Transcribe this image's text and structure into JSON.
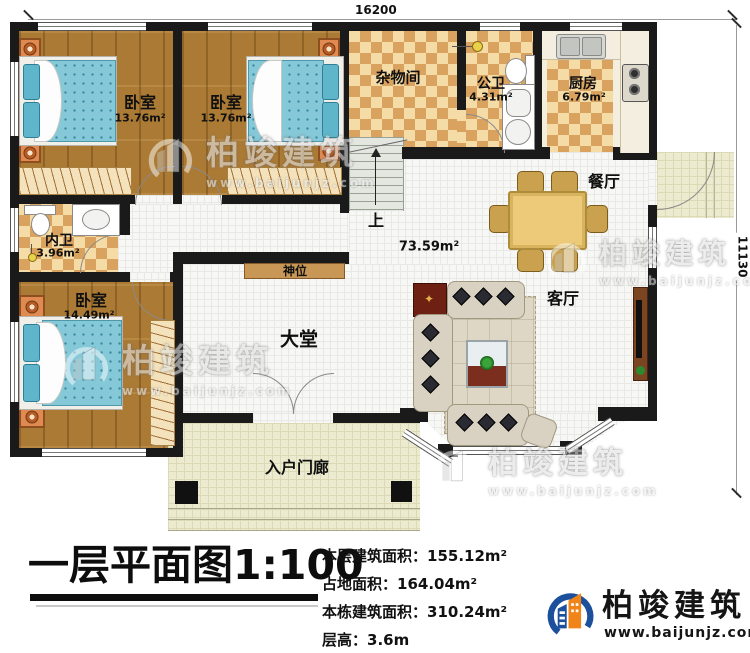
{
  "dimensions": {
    "top": "16200",
    "right": "11130"
  },
  "rooms": {
    "bedroom1": {
      "label": "卧室",
      "area": "13.76m²"
    },
    "bedroom2": {
      "label": "卧室",
      "area": "13.76m²"
    },
    "bedroom3": {
      "label": "卧室",
      "area": "14.49m²"
    },
    "storage": {
      "label": "杂物间"
    },
    "public_bath": {
      "label": "公卫",
      "area": "4.31m²"
    },
    "kitchen": {
      "label": "厨房",
      "area": "6.79m²"
    },
    "dining": {
      "label": "餐厅"
    },
    "living": {
      "label": "客厅"
    },
    "hall": {
      "label": "大堂"
    },
    "inner_bath": {
      "label": "内卫",
      "area": "3.96m²"
    },
    "porch": {
      "label": "入户门廊"
    },
    "open_area": {
      "area": "73.59m²"
    },
    "shrine": {
      "label": "神位"
    },
    "stairs": {
      "label": "上"
    }
  },
  "title_block": {
    "title": "一层平面图1:100",
    "stats": [
      {
        "label": "本层建筑面积：",
        "value": "155.12m²"
      },
      {
        "label": "占地面积：",
        "value": "164.04m²"
      },
      {
        "label": "本栋建筑面积：",
        "value": "310.24m²"
      },
      {
        "label": "层高：",
        "value": "3.6m"
      }
    ]
  },
  "brand": {
    "name": "柏竣建筑",
    "website": "www.baijunjz.com"
  },
  "colors": {
    "wall": "#1a1a1a",
    "checker_dark": "#daa25f",
    "checker_light": "#f5dca6",
    "wood": "#ab7a34",
    "logo_blue": "#1c4f9c",
    "logo_orange": "#f08418"
  }
}
